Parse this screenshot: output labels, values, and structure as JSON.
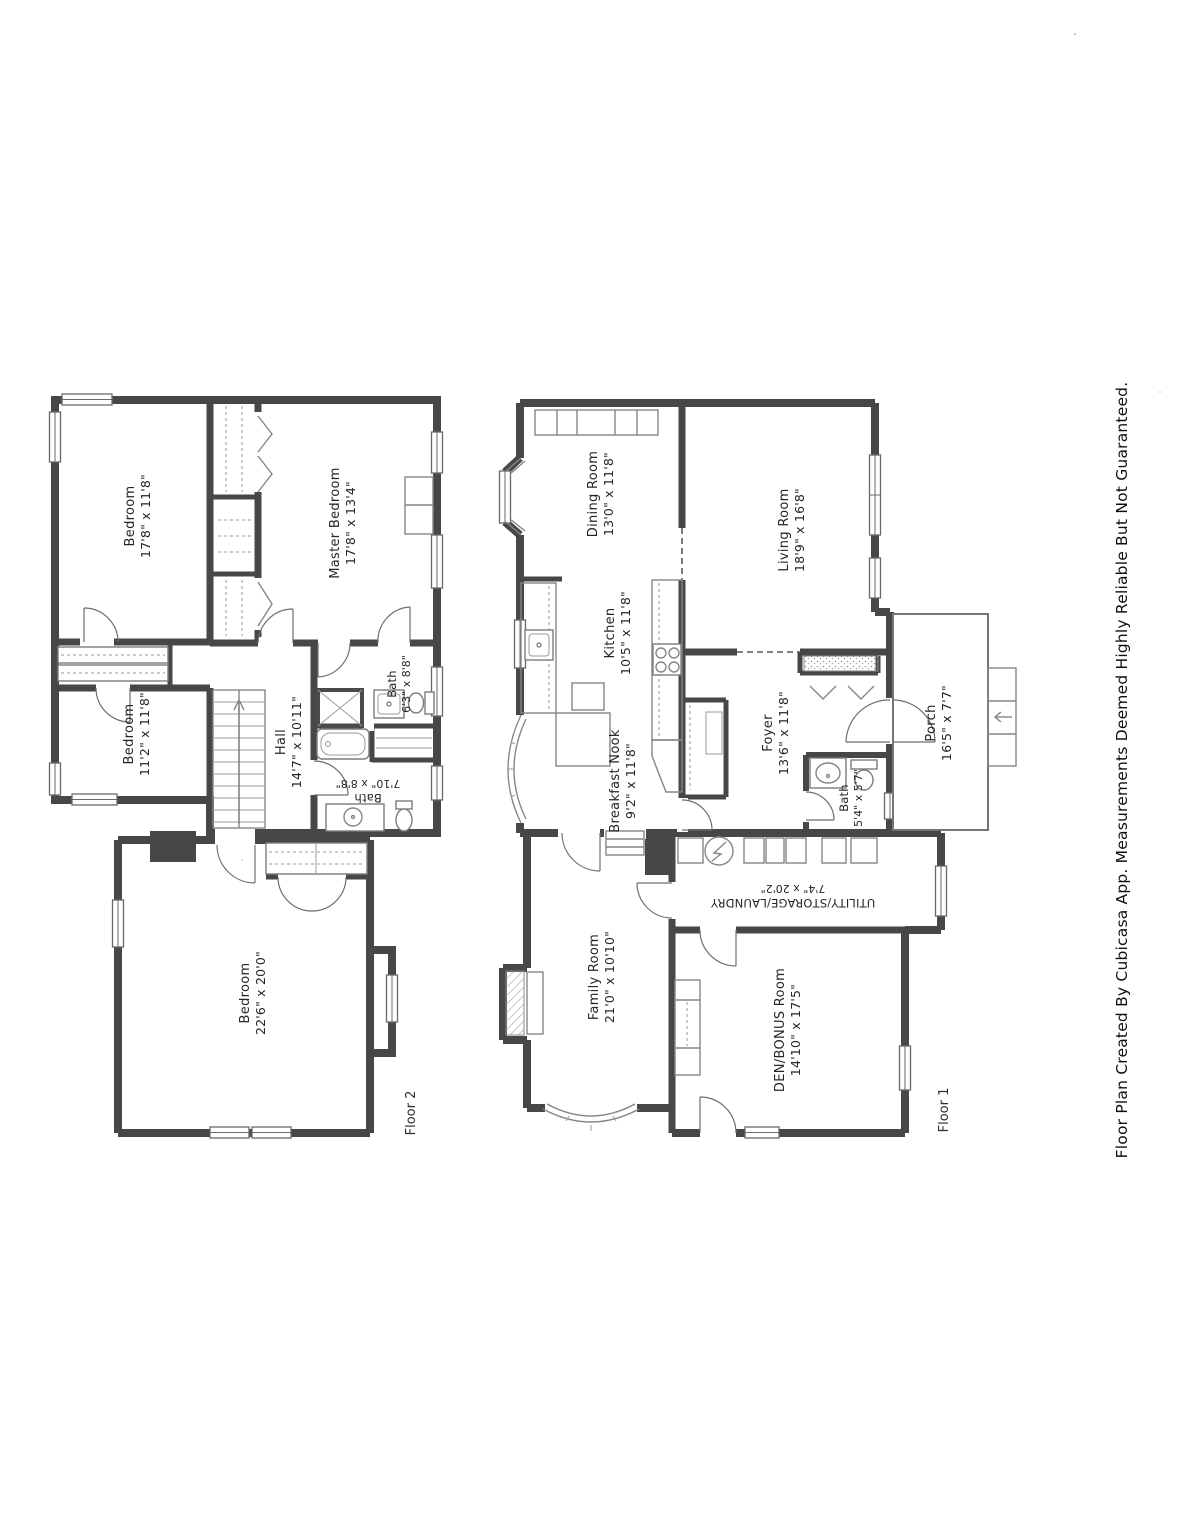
{
  "page": {
    "caption": "Floor Plan Created By Cubicasa App. Measurements Deemed Highly Reliable But Not Guaranteed."
  },
  "colors": {
    "paper": "#ffffff",
    "wall": "#474747",
    "fixture_line": "#7c7c7c",
    "text": "#262626"
  },
  "floor2": {
    "floor_label": "Floor 2",
    "rooms": {
      "bedroom_top": {
        "name": "Bedroom",
        "dims": "17'8\" x 11'8\""
      },
      "master_bedroom": {
        "name": "Master Bedroom",
        "dims": "17'8\" x 13'4\""
      },
      "bedroom_mid": {
        "name": "Bedroom",
        "dims": "11'2\" x 11'8\""
      },
      "hall": {
        "name": "Hall",
        "dims": "14'7\" x 10'11\""
      },
      "bath_upper": {
        "name": "Bath",
        "dims": "6'3\" x 8'8\""
      },
      "bath_lower": {
        "name": "Bath",
        "dims": "7'10\" x 8'8\""
      },
      "bedroom_large": {
        "name": "Bedroom",
        "dims": "22'6\" x 20'0\""
      }
    }
  },
  "floor1": {
    "floor_label": "Floor 1",
    "rooms": {
      "dining_room": {
        "name": "Dining Room",
        "dims": "13'0\" x 11'8\""
      },
      "living_room": {
        "name": "Living Room",
        "dims": "18'9\" x 16'8\""
      },
      "kitchen": {
        "name": "Kitchen",
        "dims": "10'5\" x 11'8\""
      },
      "breakfast_nook": {
        "name": "Breakfast Nook",
        "dims": "9'2\" x 11'8\""
      },
      "foyer": {
        "name": "Foyer",
        "dims": "13'6\" x 11'8\""
      },
      "bath": {
        "name": "Bath",
        "dims": "5'4\" x 5'7\""
      },
      "porch": {
        "name": "Porch",
        "dims": "16'5\" x 7'7\""
      },
      "utility": {
        "name": "UTILITY/STORAGE/LAUNDRY",
        "dims": "7'4\" x 20'2\""
      },
      "family_room": {
        "name": "Family Room",
        "dims": "21'0\" x 10'10\""
      },
      "den": {
        "name": "DEN/BONUS Room",
        "dims": "14'10\" x 17'5\""
      }
    }
  }
}
